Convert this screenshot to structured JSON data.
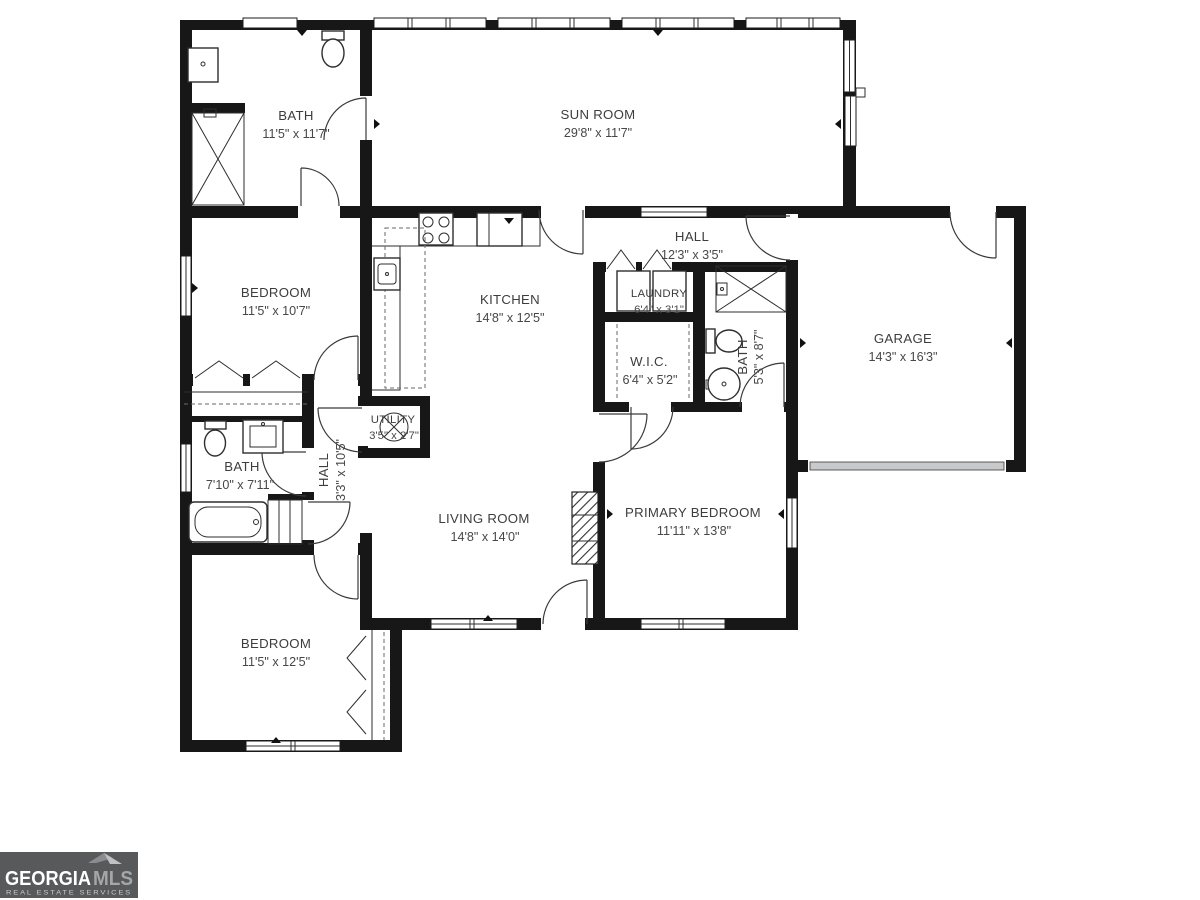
{
  "rooms": {
    "bath_top": {
      "name": "BATH",
      "dims": "11'5\" x 11'7\""
    },
    "sun_room": {
      "name": "SUN ROOM",
      "dims": "29'8\" x 11'7\""
    },
    "hall_top": {
      "name": "HALL",
      "dims": "12'3\" x 3'5\""
    },
    "bedroom_mid": {
      "name": "BEDROOM",
      "dims": "11'5\" x 10'7\""
    },
    "kitchen": {
      "name": "KITCHEN",
      "dims": "14'8\" x 12'5\""
    },
    "laundry": {
      "name": "LAUNDRY",
      "dims": "6'4\" x 3'1\""
    },
    "wic": {
      "name": "W.I.C.",
      "dims": "6'4\" x 5'2\""
    },
    "bath_right": {
      "name": "BATH",
      "dims": "5'3\" x 8'7\""
    },
    "garage": {
      "name": "GARAGE",
      "dims": "14'3\" x 16'3\""
    },
    "utility": {
      "name": "UTILITY",
      "dims": "3'5\" x 2'7\""
    },
    "hall_left": {
      "name": "HALL",
      "dims": "3'3\" x 10'5\""
    },
    "bath_left": {
      "name": "BATH",
      "dims": "7'10\" x 7'11\""
    },
    "living_room": {
      "name": "LIVING ROOM",
      "dims": "14'8\" x 14'0\""
    },
    "primary_bedroom": {
      "name": "PRIMARY BEDROOM",
      "dims": "11'11\" x 13'8\""
    },
    "bedroom_bottom": {
      "name": "BEDROOM",
      "dims": "11'5\" x 12'5\""
    }
  },
  "logo": {
    "brand_primary": "GEORGIA",
    "brand_secondary": "MLS",
    "tagline": "REAL ESTATE SERVICES"
  },
  "colors": {
    "wall": "#171717",
    "label": "#3d3d3d",
    "logo_bg": "#58595b",
    "logo_secondary": "#a4a6a9",
    "garage_door": "#c8c9ca"
  }
}
